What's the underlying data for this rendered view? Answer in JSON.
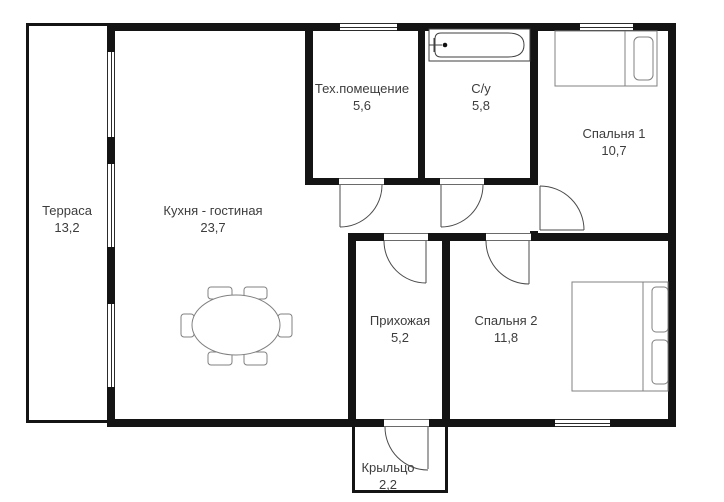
{
  "title": "Floor plan",
  "rooms": [
    {
      "id": "terrace",
      "name": "Терраса",
      "area": "13,2"
    },
    {
      "id": "kitchen",
      "name": "Кухня - гостиная",
      "area": "23,7"
    },
    {
      "id": "tech",
      "name": "Тех.помещение",
      "area": "5,6"
    },
    {
      "id": "bath",
      "name": "С/у",
      "area": "5,8"
    },
    {
      "id": "bedroom1",
      "name": "Спальня 1",
      "area": "10,7"
    },
    {
      "id": "bedroom2",
      "name": "Спальня 2",
      "area": "11,8"
    },
    {
      "id": "hallway",
      "name": "Прихожая",
      "area": "5,2"
    },
    {
      "id": "porch",
      "name": "Крыльцо",
      "area": "2,2"
    }
  ],
  "colors": {
    "wall": "#141414",
    "text": "#3d3d3d",
    "door_line": "#4b4b4b",
    "furniture_line": "#808080",
    "background": "#ffffff"
  }
}
